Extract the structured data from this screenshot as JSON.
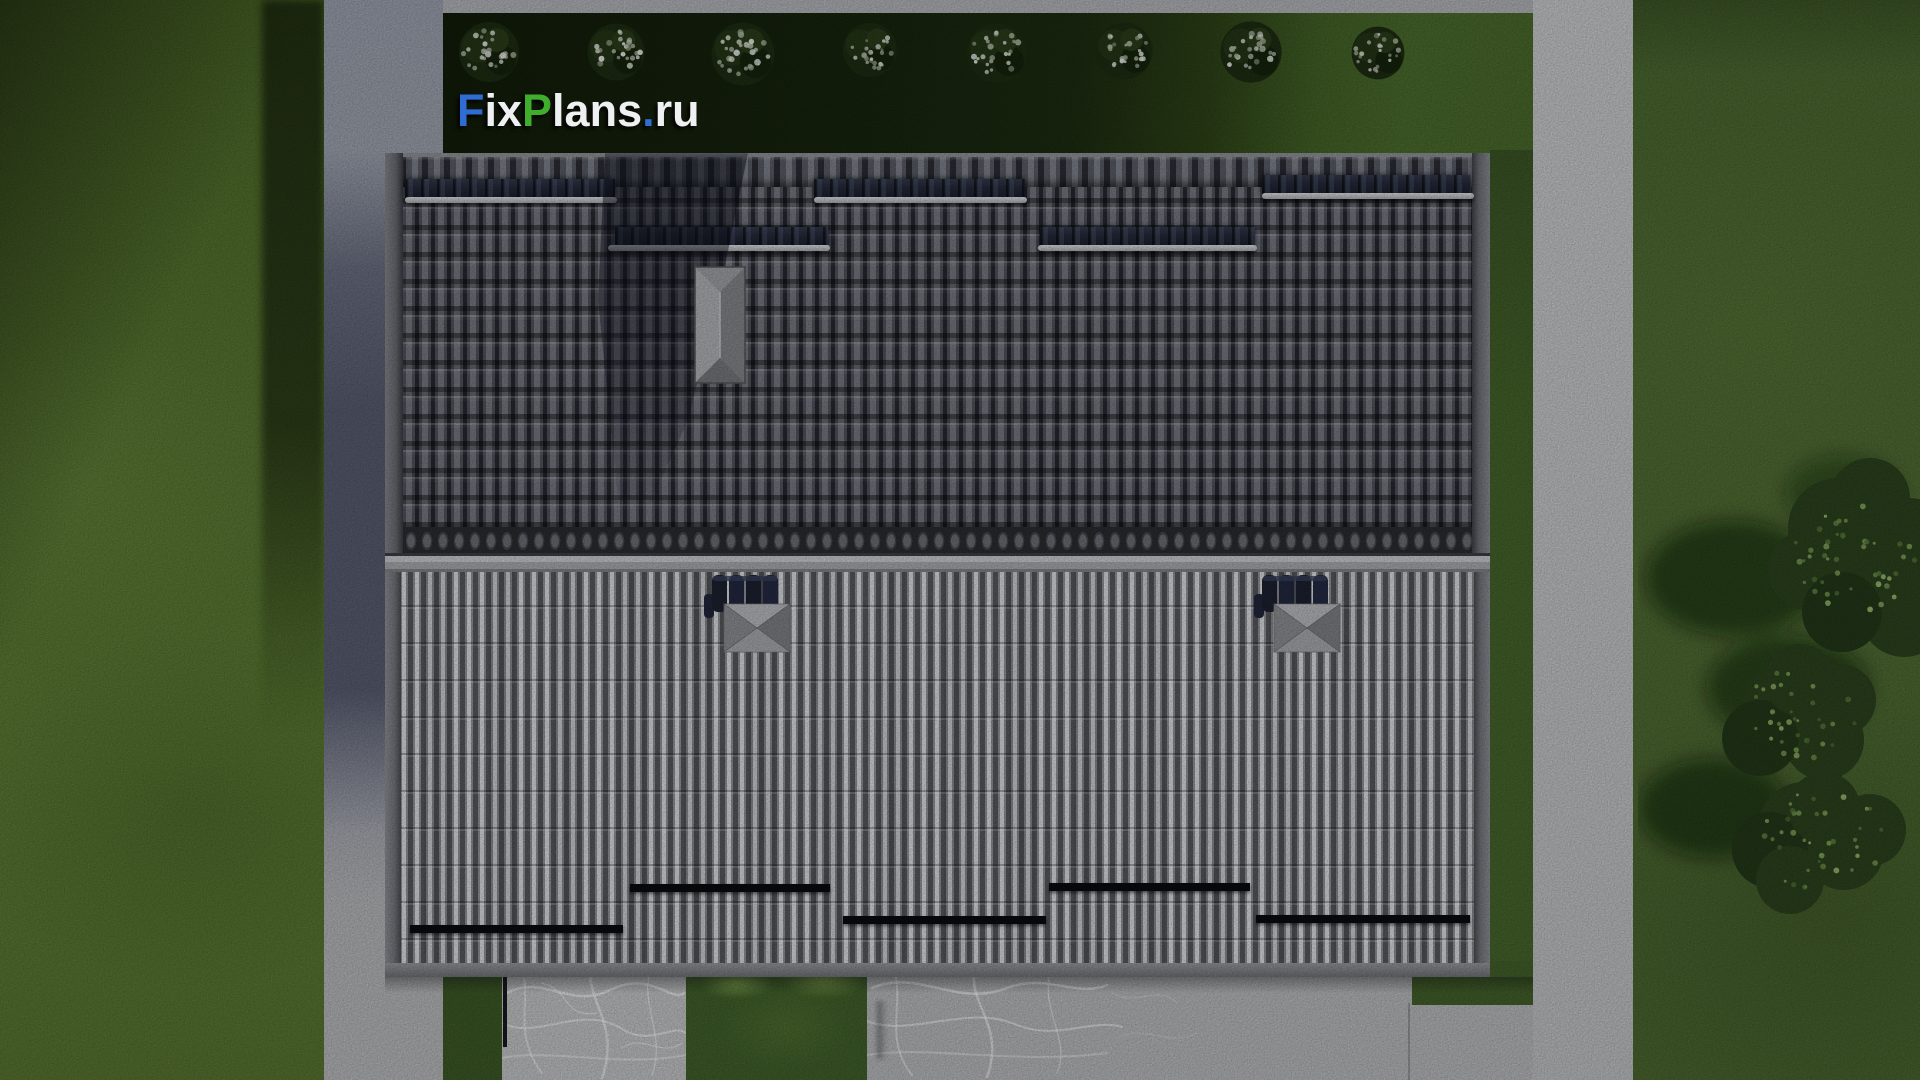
{
  "scene": {
    "title": "Aerial top-down render of a house roof with lawn, paths and driveway",
    "watermark": {
      "text": "FixPlans.ru",
      "segments": [
        {
          "text": "F",
          "color": "#2f6dd4"
        },
        {
          "text": "ix",
          "color": "#eef0f2"
        },
        {
          "text": "P",
          "color": "#3fae2c"
        },
        {
          "text": "lans",
          "color": "#eef0f2"
        },
        {
          "text": ".",
          "color": "#2f6dd4"
        },
        {
          "text": "ru",
          "color": "#eef0f2"
        }
      ]
    }
  },
  "palette": {
    "grass": "#57752f",
    "lawn_shadow": "#18250e",
    "concrete_path": "#b6b7b9",
    "concrete_path_shaded": "#3f4560",
    "roof_tiles_dark": "#4e515a",
    "roof_metal_light": "#d9dadd",
    "vent_band_navy": "#232838",
    "snow_rail": "#c0c2c6",
    "gutter_bar_black": "#0a0b0e",
    "marble_pad": "#c3c4c6",
    "logo_blue": "#2f6dd4",
    "logo_green": "#3fae2c",
    "logo_white": "#eef0f2"
  },
  "objects": {
    "shrub_row_count": 8,
    "roof_vent_bands": 5,
    "roof_snow_rails": 5,
    "roof_hatch_units": 2,
    "chimney_count": 1,
    "eave_gutter_bars": 5,
    "terrace_pads": 2,
    "tree_clusters": 3
  }
}
